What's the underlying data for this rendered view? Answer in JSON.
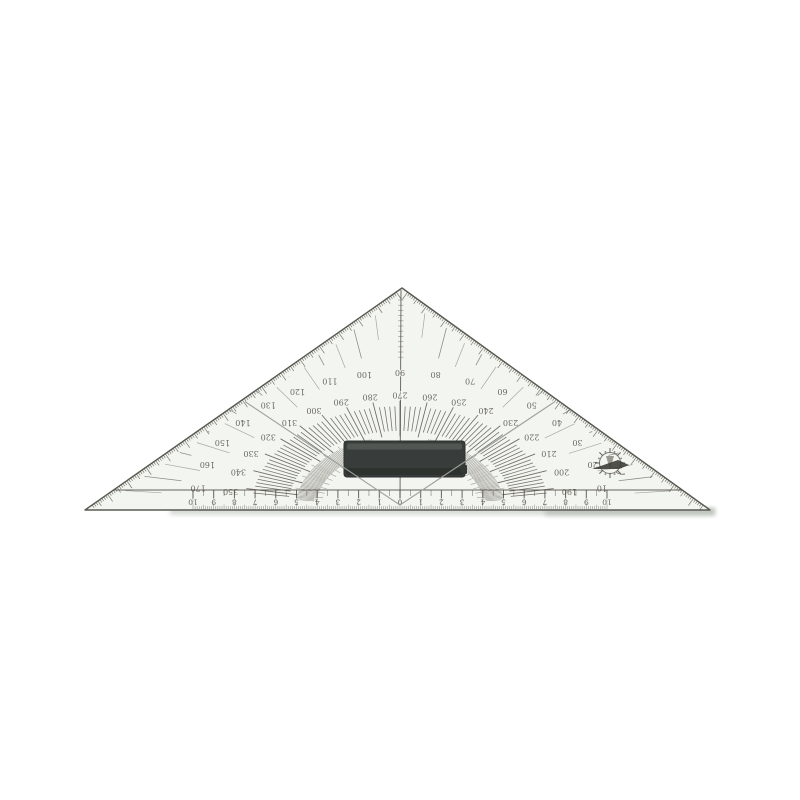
{
  "photo": {
    "subject": "protractor-triangle-ruler",
    "background_color": "#ffffff"
  },
  "colors": {
    "body": "#f3f5f1",
    "edge": "#585b52",
    "ink": "#4e4a41",
    "faint_ink": "#6a675e",
    "guide_line": "#9aa09b",
    "handle_dark": "#383d3b",
    "handle_mid": "#464b48",
    "handle_light": "#5a5f5c",
    "shadow": "#b9bdb8"
  },
  "protractor": {
    "outer_labels": [
      10,
      20,
      30,
      40,
      50,
      60,
      70,
      80,
      90,
      100,
      110,
      120,
      130,
      140,
      150,
      160,
      170
    ],
    "inner_labels": [
      190,
      200,
      210,
      220,
      230,
      240,
      250,
      260,
      270,
      280,
      290,
      300,
      310,
      320,
      330,
      340,
      350
    ],
    "label_step": 10,
    "labels_rotated_180": true
  },
  "ruler": {
    "center_label": "0",
    "numbers": [
      1,
      2,
      3,
      4,
      5,
      6,
      7,
      8,
      9,
      10
    ],
    "sides": 2,
    "numbers_rotated_180": true
  },
  "icons": {
    "logo": "compass-rose-logo"
  }
}
